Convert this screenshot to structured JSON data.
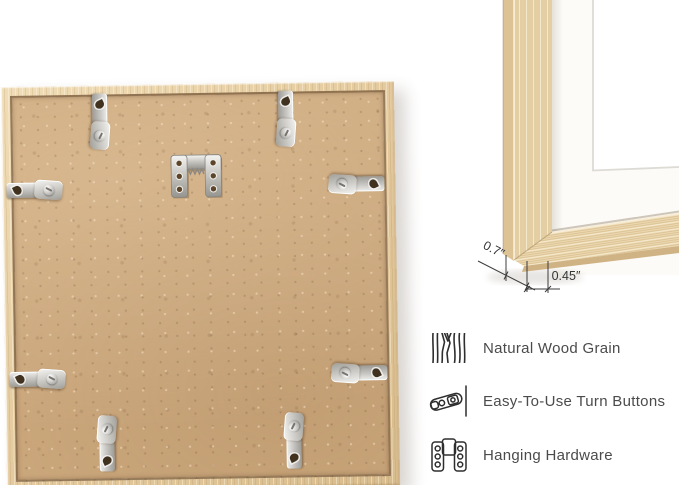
{
  "image": {
    "type": "product-photo",
    "background": "#ffffff"
  },
  "back_view": {
    "wood_color": "#e4ca9e",
    "board_color": "#cda97e",
    "metal_color": "#c9c7c2",
    "turn_button_count": 8,
    "hardware": [
      "sawtooth-hanger",
      "turn-buttons",
      "keyhole-hangers"
    ]
  },
  "corner_view": {
    "depth_label": "0.7″",
    "face_width_label": "0.45″",
    "mat_color": "#fcfbf8",
    "line_color": "#3c3c3c"
  },
  "features": [
    {
      "icon": "wood-grain-icon",
      "label": "Natural Wood Grain"
    },
    {
      "icon": "turn-button-icon",
      "label": "Easy-To-Use Turn Buttons"
    },
    {
      "icon": "hanging-hardware-icon",
      "label": "Hanging Hardware"
    }
  ],
  "text_color": "#4b4b4b"
}
